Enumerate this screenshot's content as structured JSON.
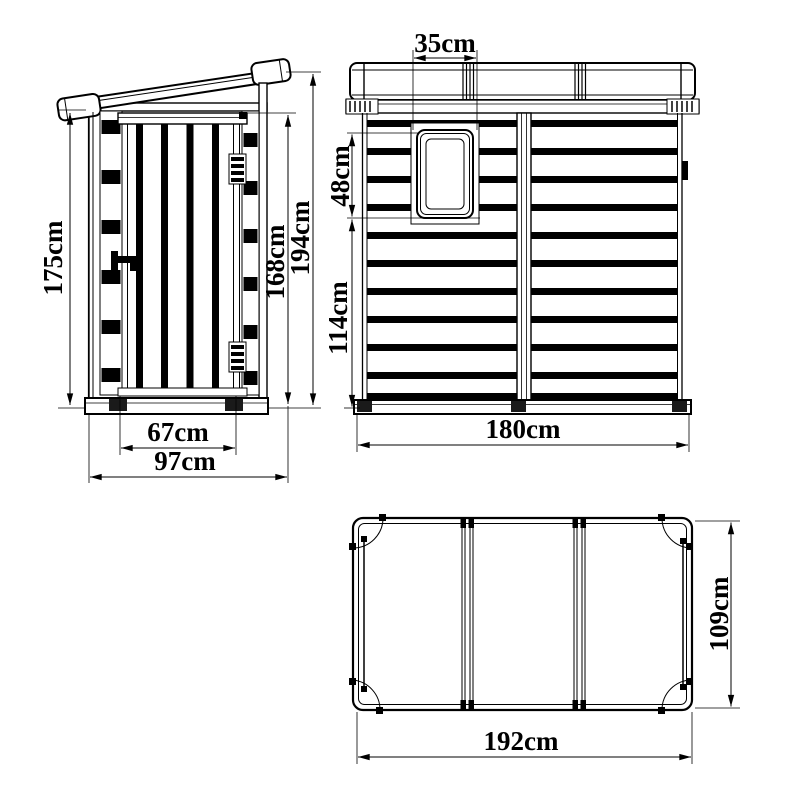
{
  "drawing": {
    "background": "#ffffff",
    "line_color": "#000000",
    "unit": "cm",
    "side_view": {
      "dims": {
        "overall_height_low": "175cm",
        "door_width": "67cm",
        "overall_depth": "97cm",
        "wall_height": "168cm",
        "overall_height_high": "194cm"
      }
    },
    "front_view": {
      "dims": {
        "window_width": "35cm",
        "window_height": "48cm",
        "below_window_height": "114cm",
        "overall_width": "180cm"
      }
    },
    "top_view": {
      "dims": {
        "overall_width": "192cm",
        "overall_depth": "109cm"
      }
    }
  }
}
